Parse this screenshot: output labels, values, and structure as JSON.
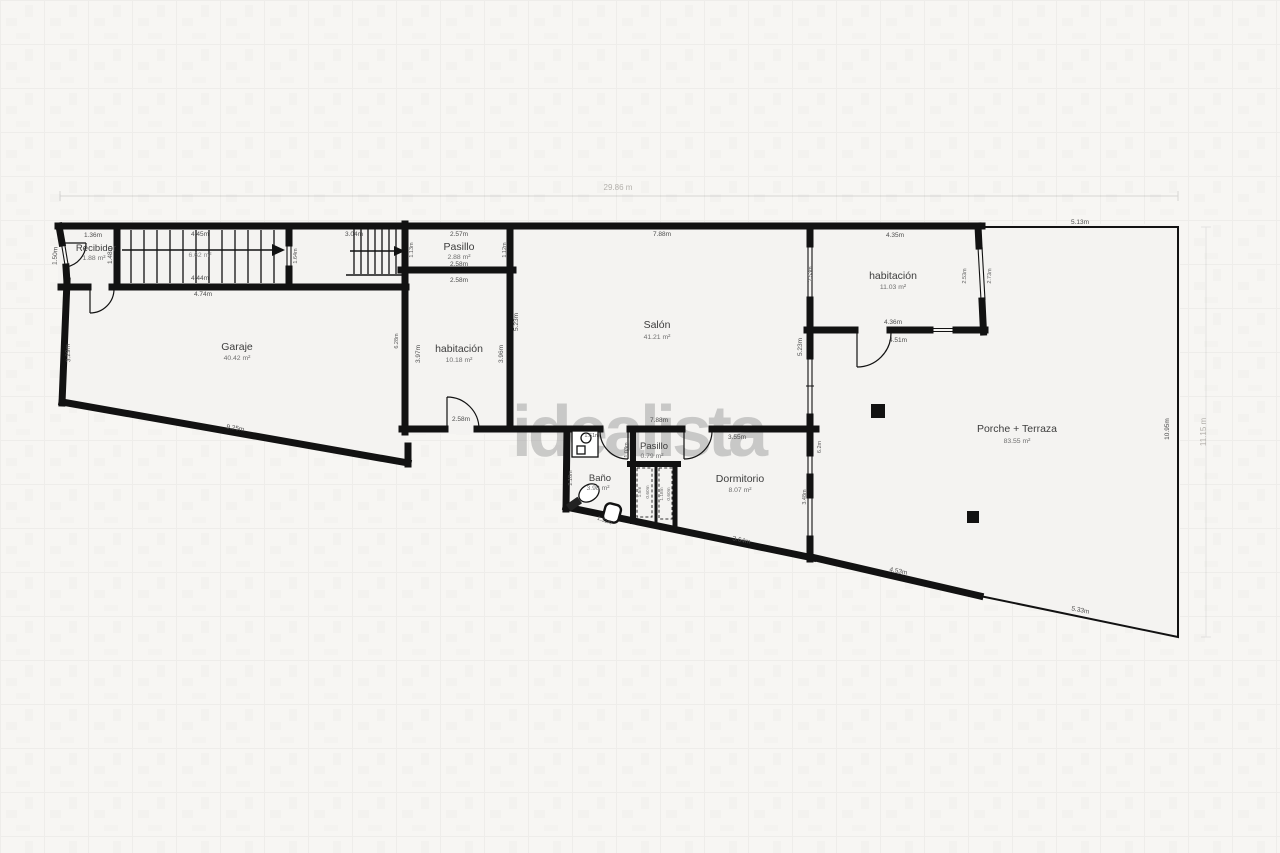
{
  "watermark": "idealista",
  "overall_dims": {
    "top": "29.86 m",
    "right": "11.15 m"
  },
  "rooms": {
    "recibidor": {
      "name": "Recibidor",
      "area": "1.88 m²"
    },
    "stairs": {
      "area": "6.62 m²"
    },
    "garaje": {
      "name": "Garaje",
      "area": "40.42 m²"
    },
    "pasillo_top": {
      "name": "Pasillo",
      "area": "2.88 m²"
    },
    "habitacion_mid": {
      "name": "habitación",
      "area": "10.18 m²"
    },
    "salon": {
      "name": "Salón",
      "area": "41.21 m²"
    },
    "habitacion_right": {
      "name": "habitación",
      "area": "11.03 m²"
    },
    "porche": {
      "name": "Porche + Terraza",
      "area": "83.55 m²"
    },
    "bano": {
      "name": "Baño",
      "area": "3.98 m²"
    },
    "pasillo_small": {
      "name": "Pasillo",
      "area": "0.79 m²"
    },
    "dormitorio": {
      "name": "Dormitorio",
      "area": "8.07 m²"
    }
  },
  "dims": {
    "recibidor_top": "1.36m",
    "recibidor_left": "1.50m",
    "recibidor_right": "1.48m",
    "stairs_top": "4.45m",
    "stairs_bottom": "4.44m",
    "stairs_below": "4.74m",
    "stairs_gap": "1.64m",
    "stairs2_top": "3.04m",
    "pasillo_top_w": "2.57m",
    "pasillo_bottom_w": "2.58m",
    "pasillo_left": "1.13m",
    "pasillo_right": "1.12m",
    "habmid_top": "2.58m",
    "habmid_left": "3.97m",
    "habmid_right": "3.96m",
    "habmid_door": "2.58m",
    "habmid_outer_left": "6.28m",
    "garaje_bottom": "9.25m",
    "garaje_left": "3.29m",
    "salon_top": "7.88m",
    "salon_bottom": "7.88m",
    "salon_left": "5.23m",
    "salon_right": "5.23m",
    "habr_top": "4.35m",
    "habr_left": "2.53m",
    "habr_right_in": "2.53m",
    "habr_right_out": "2.73m",
    "habr_bottom": "4.36m",
    "habr_below": "4.51m",
    "porche_top": "5.13m",
    "porche_right": "10.95m",
    "porche_left": "6.2m",
    "porche_bottom_left": "4.53m",
    "porche_bottom_right": "5.33m",
    "dorm_top": "3.55m",
    "dorm_right": "3.48m",
    "dorm_bottom": "3.64m",
    "bano_left": "2.18m",
    "bano_bottom": "1.31m",
    "bano_top": "1.61m",
    "pasillo_small_left": "1.03m",
    "closet1_h": "1.5m",
    "closet1_w": "0.60m",
    "closet2_h": "1.18m",
    "closet2_w": "0.60m"
  },
  "colors": {
    "wall": "#121212",
    "bg": "#f7f6f3",
    "room": "#f4f3f1",
    "watermark": "#8e8e8e"
  }
}
